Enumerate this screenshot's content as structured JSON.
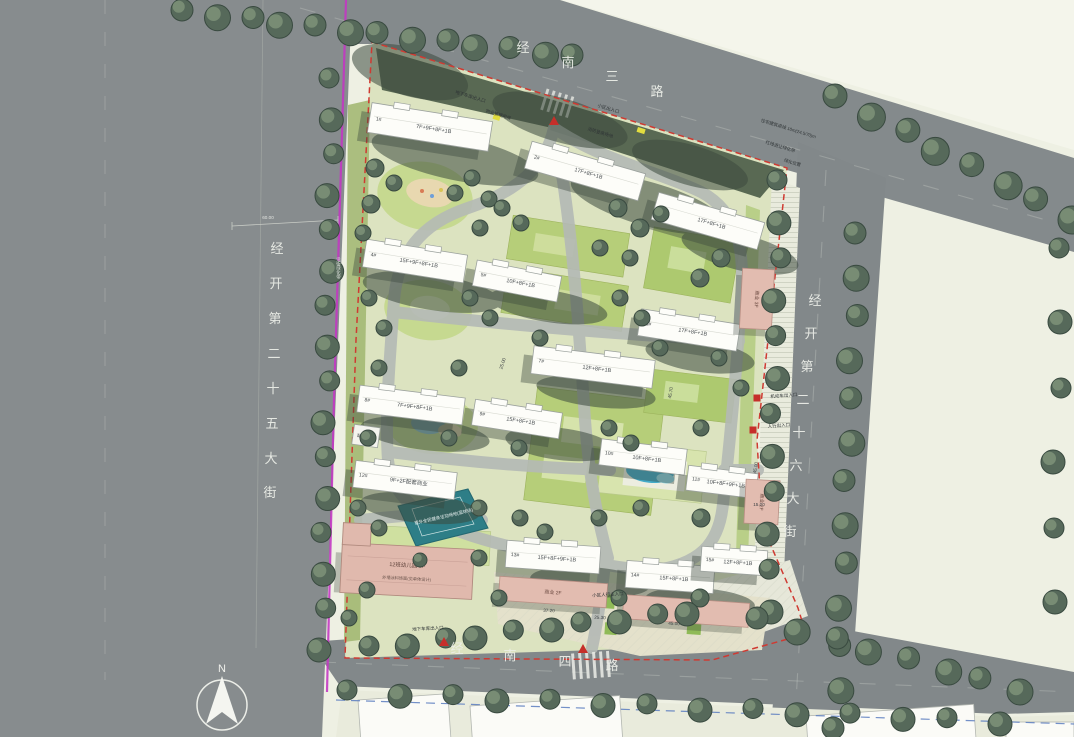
{
  "compass": {
    "label": "N"
  },
  "roads": {
    "north": {
      "name": "经南三路",
      "chars": [
        "经",
        "南",
        "三",
        "路"
      ]
    },
    "west": {
      "name": "经开第二十五大街",
      "chars": [
        "经",
        "开",
        "第",
        "二",
        "十",
        "五",
        "大",
        "街"
      ]
    },
    "east": {
      "name": "经开第二十六大街",
      "chars": [
        "经",
        "开",
        "第",
        "二",
        "十",
        "六",
        "大",
        "街"
      ]
    },
    "south": {
      "name": "经南四路",
      "chars": [
        "经",
        "南",
        "四",
        "路"
      ]
    }
  },
  "colors": {
    "road": "#848a8c",
    "site_boundary": "#cf3a32",
    "property_line": "#c237c2",
    "parcel_line": "#5b7cc0",
    "lawn": "#b6ce79",
    "tree": "#56695a",
    "building": "#fdfdf9",
    "commercial": "#e2bcb0",
    "court": "#2e7e87",
    "pool": "#43abc9"
  },
  "buildings": [
    {
      "num": "1#",
      "label": "7F+9F+8F+1B"
    },
    {
      "num": "2#",
      "label": "17F+8F+1B"
    },
    {
      "num": "3#",
      "label": "17F+8F+1B"
    },
    {
      "num": "4#",
      "label": "15F+9F+8F+1B"
    },
    {
      "num": "5#",
      "label": "10F+8F+1B"
    },
    {
      "num": "6#",
      "label": "17F+8F+1B"
    },
    {
      "num": "7#",
      "label": "12F+8F+1B"
    },
    {
      "num": "8#",
      "label": "7F+9F+8F+1B"
    },
    {
      "num": "9#",
      "label": "15F+8F+1B"
    },
    {
      "num": "10#",
      "label": "10F+8F+1B"
    },
    {
      "num": "11#",
      "label": "10F+8F+9F+1B"
    },
    {
      "num": "12#",
      "label": "9F+2F配套商业"
    },
    {
      "num": "13#",
      "label": "15F+8F+9F+1B"
    },
    {
      "num": "14#",
      "label": "15F+8F+1B"
    },
    {
      "num": "15#",
      "label": "12F+8F+1B"
    }
  ],
  "commercial": [
    {
      "label": "商业 2F"
    },
    {
      "label": "商业 2F"
    },
    {
      "label": "商业 2F"
    },
    {
      "label": "商业 3F"
    }
  ],
  "facilities": {
    "kindergarten": {
      "label": "12班幼儿园 3F",
      "note": "外墙涂料饰面(见单体设计)"
    },
    "court": {
      "label": "室外全民健身活动场地(篮球场)"
    },
    "substation": {
      "label": "配电站 1F"
    }
  },
  "entrances": [
    {
      "label": "地下车库出入口"
    },
    {
      "label": "小区出入口"
    },
    {
      "label": "机动车出入口"
    },
    {
      "label": "人行出入口"
    },
    {
      "label": "小区人行主入口"
    },
    {
      "label": "地下车库出入口"
    }
  ],
  "dimensions": [
    "60.00",
    "25.00",
    "45.70",
    "45.00",
    "15.00",
    "37.20",
    "25.30",
    "45.00"
  ],
  "annotations": [
    "住宅建筑退线 10m(24.5/70)m",
    "红线退让绿化带",
    "绿化位置",
    "物业管理用房",
    "消防登高场地",
    "沿街绿化带"
  ]
}
